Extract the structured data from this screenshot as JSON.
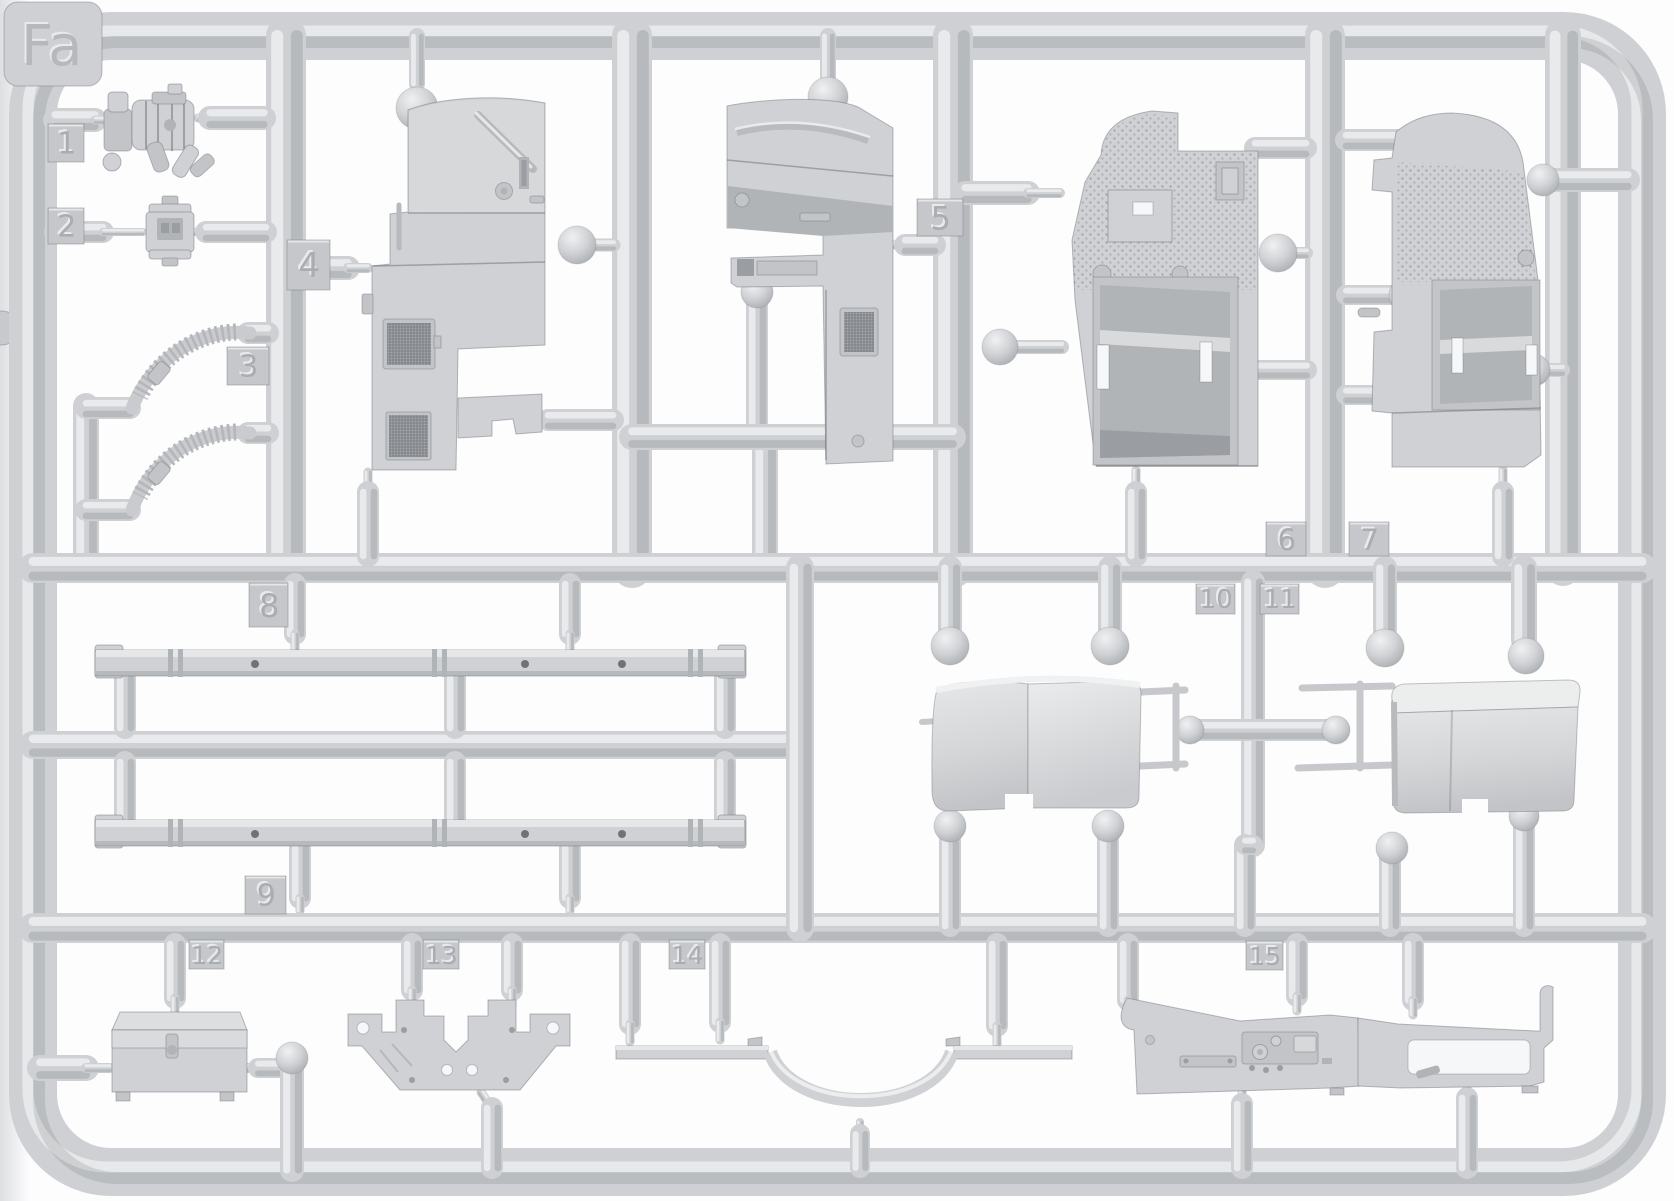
{
  "sprue": {
    "label": "Fa",
    "part_tags": [
      "1",
      "2",
      "3",
      "4",
      "5",
      "6",
      "7",
      "8",
      "9",
      "10",
      "11",
      "12",
      "13",
      "14",
      "15"
    ],
    "colors": {
      "background": "#fdfdfe",
      "plastic": "#ced0d3",
      "plastic_highlight": "#eceeef",
      "plastic_shadow": "#a9acb0",
      "part_fill": "#cfd1d4",
      "mesh_dark": "#7e8186",
      "tag_plate": "#c5c7ca",
      "tag_text": "#a9acb0",
      "tag_text_highlight": "#e9eaec"
    }
  }
}
